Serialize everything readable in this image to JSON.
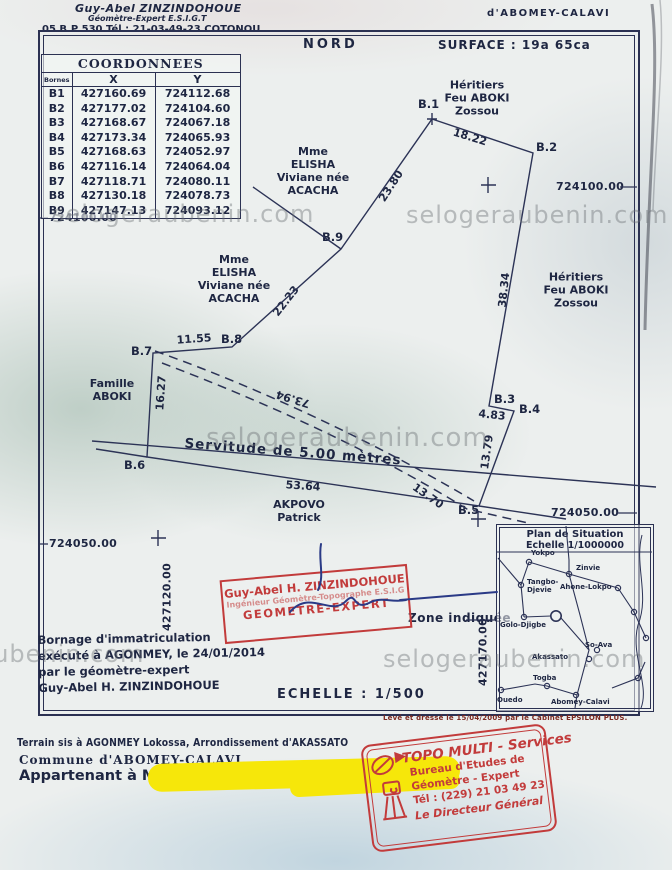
{
  "header": {
    "name": "Guy-Abel ZINZINDOHOUE",
    "role": "Géomètre-Expert  E.S.I.G.T",
    "contact": "05 B.P 530    Tél : 21-03-49-23  COTONOU",
    "place": "d'ABOMEY-CALAVI"
  },
  "frame": {
    "nord": "NORD",
    "surface": "SURFACE : 19a  65ca",
    "echelle": "ECHELLE : 1/500",
    "leve": "Levé et dressé le 15/04/2009 par le Cabinet EPSILON PLUS."
  },
  "table": {
    "title": "COORDONNEES",
    "col_bornes": "Bornes",
    "col_x": "X",
    "col_y": "Y",
    "rows": [
      {
        "b": "B1",
        "x": "427160.69",
        "y": "724112.68"
      },
      {
        "b": "B2",
        "x": "427177.02",
        "y": "724104.60"
      },
      {
        "b": "B3",
        "x": "427168.67",
        "y": "724067.18"
      },
      {
        "b": "B4",
        "x": "427173.34",
        "y": "724065.93"
      },
      {
        "b": "B5",
        "x": "427168.63",
        "y": "724052.97"
      },
      {
        "b": "B6",
        "x": "427116.14",
        "y": "724064.04"
      },
      {
        "b": "B7",
        "x": "427118.71",
        "y": "724080.11"
      },
      {
        "b": "B8",
        "x": "427130.18",
        "y": "724078.73"
      },
      {
        "b": "B9",
        "x": "427147.13",
        "y": "724093.12"
      }
    ]
  },
  "plan": {
    "points": {
      "p1": "B.1",
      "p2": "B.2",
      "p3": "B.3",
      "p4": "B.4",
      "p5": "B.5",
      "p6": "B.6",
      "p7": "B.7",
      "p8": "B.8",
      "p9": "B.9"
    },
    "measures": {
      "b1b2": "18.22",
      "b9b1": "23.80",
      "b8b9": "22.23",
      "b7b8": "11.55",
      "b6b7": "16.27",
      "b2b3": "38.34",
      "b3b4": "4.83",
      "b4b5": "13.79",
      "b6b5": "53.64",
      "dash_long": "73.94",
      "dash_short": "13.70"
    },
    "servitude": "Servitude de 5.00 mètres",
    "owners": {
      "heritiers_top": "Héritiers\nFeu ABOKI\nZossou",
      "elisha_1": "Mme\nELISHA\nViviane née\nACACHA",
      "elisha_2": "Mme\nELISHA\nViviane née\nACACHA",
      "famille": "Famille\nABOKI",
      "heritiers_right": "Héritiers\nFeu ABOKI\nZossou",
      "akpovo": "AKPOVO\nPatrick"
    }
  },
  "grid": {
    "y_top": "724100.00",
    "y_mid": "724050.00",
    "x_left": "427120.00",
    "x_right": "427170.00"
  },
  "watermark": {
    "text": "selogeraubenin.com"
  },
  "situation": {
    "title": "Plan de Situation",
    "scale": "Echelle 1/1000000",
    "zone": "Zone indiquée",
    "places": {
      "yokpo": "Yokpo",
      "zinvie": "Zinvie",
      "tangbo": "Tangbo-\nDjevie",
      "ahone": "Ahone-Lokpo",
      "golo": "Golo-Djigbe",
      "soava": "So-Ava",
      "akassato": "Akassato",
      "togba": "Togba",
      "ouedo": "Ouedo",
      "abomey": "Abomey-Calavi"
    }
  },
  "stamp_center": {
    "l1": "Guy-Abel H. ZINZINDOHOUE",
    "l2": "Ingénieur Géomètre-Topographe E.S.I.G",
    "l3": "GEOMETRE-EXPERT"
  },
  "bornage": {
    "text": "Bornage d'immatriculation\nexécuté à AGONMEY, le 24/01/2014\npar le géomètre-expert\nGuy-Abel H. ZINZINDOHOUE"
  },
  "footer": {
    "l1": "Terrain sis à AGONMEY Lokossa, Arrondissement d'AKASSATO",
    "l2": "Commune d'ABOMEY-CALAVI.",
    "l3": "Appartenant à M"
  },
  "stamp_topo": {
    "l1": "TOPO MULTI - Services",
    "l2": "Bureau d'Etudes de",
    "l3": "Géomètre  - Expert",
    "l4": "Tél : (229) 21 03 49 23",
    "l5": "Le Directeur Général"
  }
}
